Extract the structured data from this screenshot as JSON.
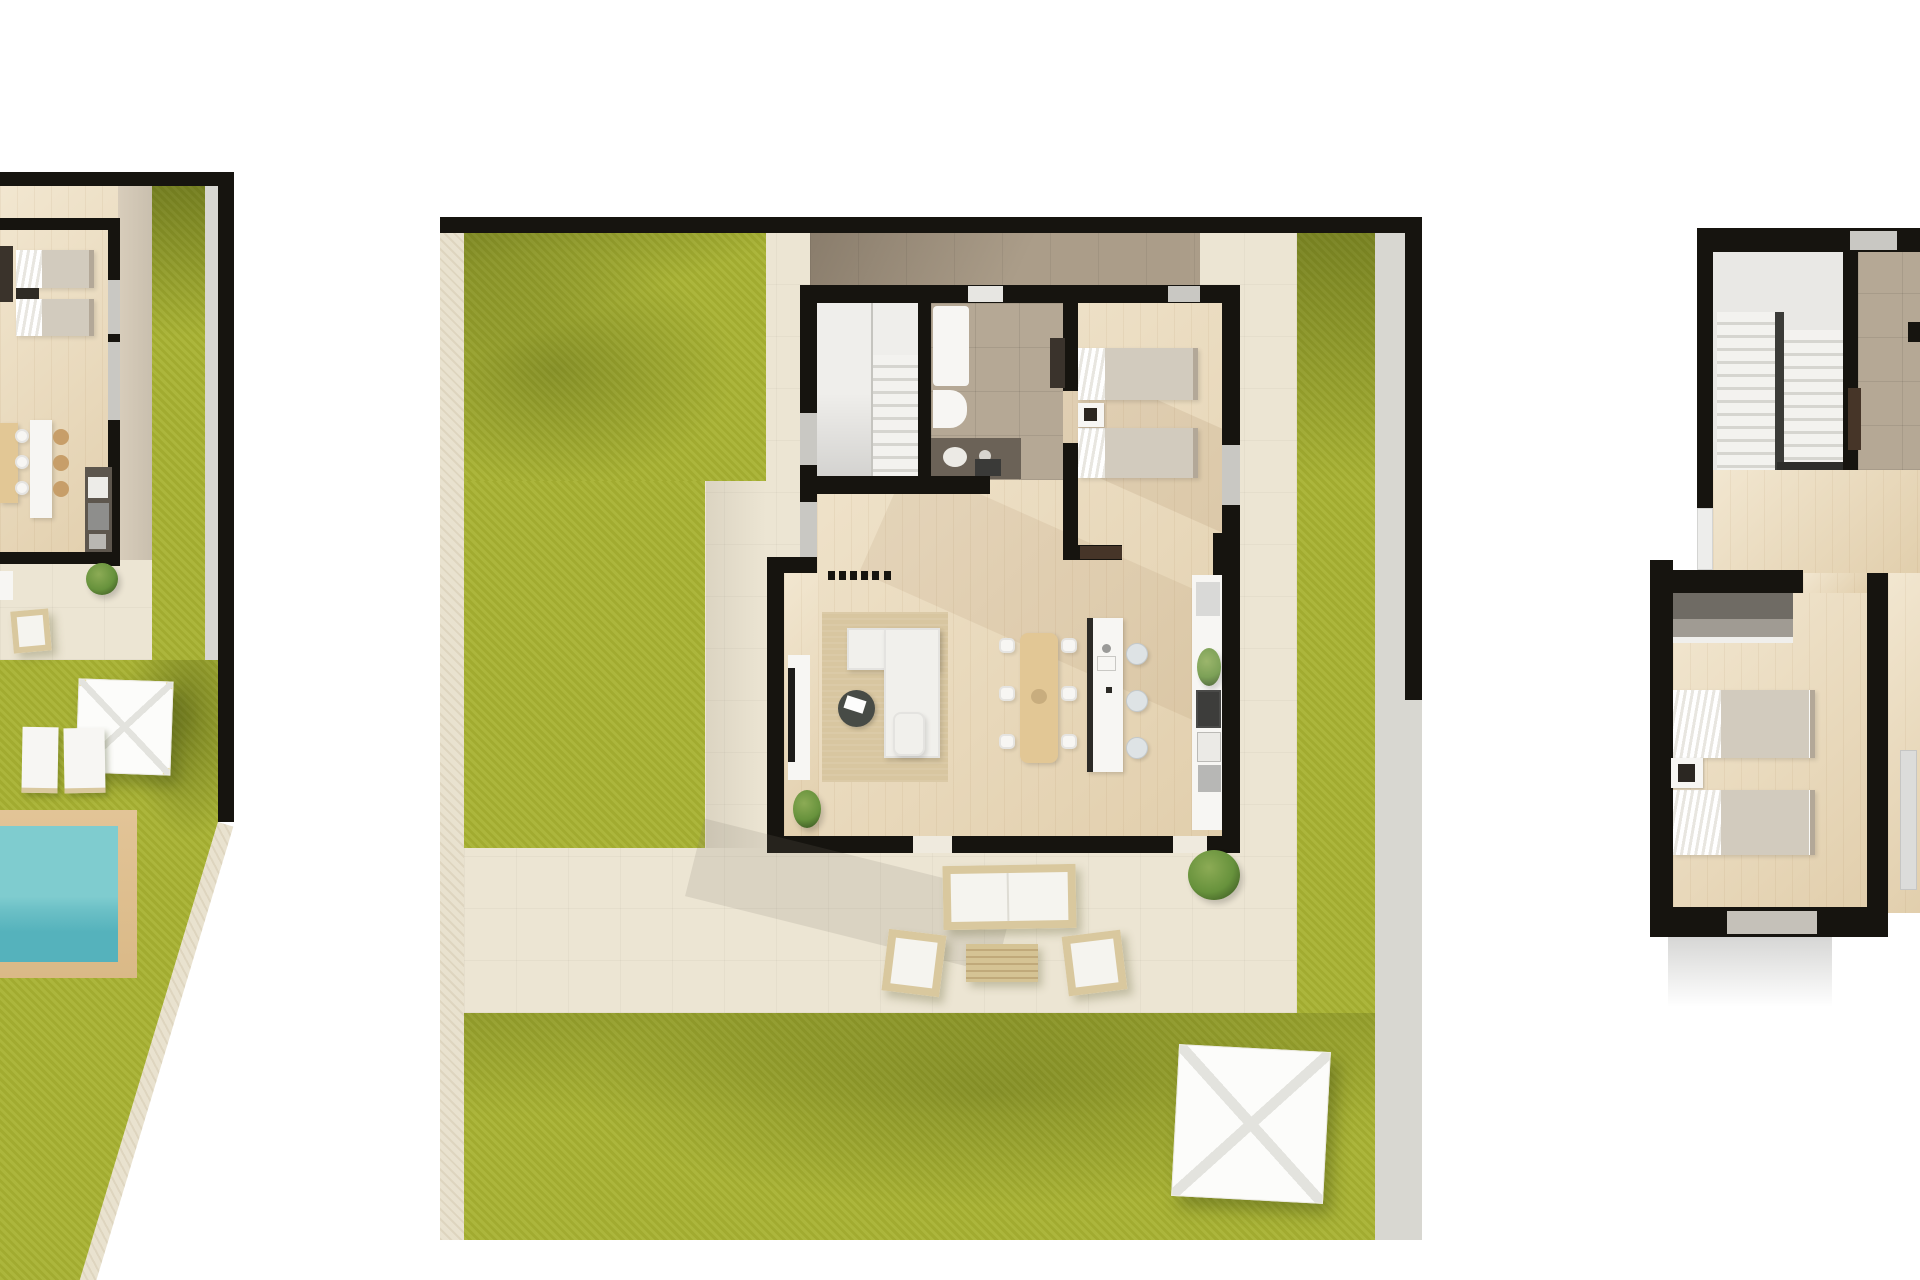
{
  "page": {
    "title": "Villa floor plans — top-down 3D renders",
    "background": "#ffffff"
  },
  "colors": {
    "bg": "#ffffff",
    "wall": "#16140f",
    "grass": "#a8b232",
    "deck": "#ece5d3",
    "stone": "#e9e2cf",
    "path": "#d8d7d1",
    "wood": "#ecdcbc",
    "porch": "#ab9d89",
    "tile": "#b5a895",
    "stair": "#efeeeb",
    "fixture": "#f7f6f3",
    "counter-dark": "#5d564d",
    "wood-furniture": "#e2c795",
    "rug": "#d8c6a0",
    "sofa": "#f1f0ec",
    "wicker": "#d9c89e",
    "cushion": "#f5f4ef",
    "pool-border": "#dab987",
    "pool-water": "#7fcccf",
    "pool-water-deep": "#55b2bc",
    "plant": "#67923c",
    "window": "#c9c8c3",
    "door-dark": "#463528",
    "blanket": "#d2cbbe",
    "wardrobe": "#6f6b64"
  },
  "plans": {
    "left": {
      "id": "plan-left",
      "name": "ground-floor-villa-cropped",
      "rooms": [
        "bedroom-twin",
        "kitchen",
        "dining-area"
      ],
      "outdoor": [
        "garden",
        "patio",
        "pergola",
        "sun-loungers",
        "swimming-pool"
      ]
    },
    "center": {
      "id": "plan-center",
      "name": "ground-floor-villa",
      "rooms": [
        "staircase",
        "bathroom",
        "bedroom-twin",
        "living-room",
        "dining-area",
        "kitchen",
        "entrance-porch"
      ],
      "outdoor": [
        "garden",
        "terrace",
        "outdoor-lounge-set",
        "parasol"
      ]
    },
    "right": {
      "id": "plan-right",
      "name": "upper-floor-villa-cropped",
      "rooms": [
        "staircase",
        "landing",
        "bedroom-twin",
        "hallway"
      ]
    }
  }
}
